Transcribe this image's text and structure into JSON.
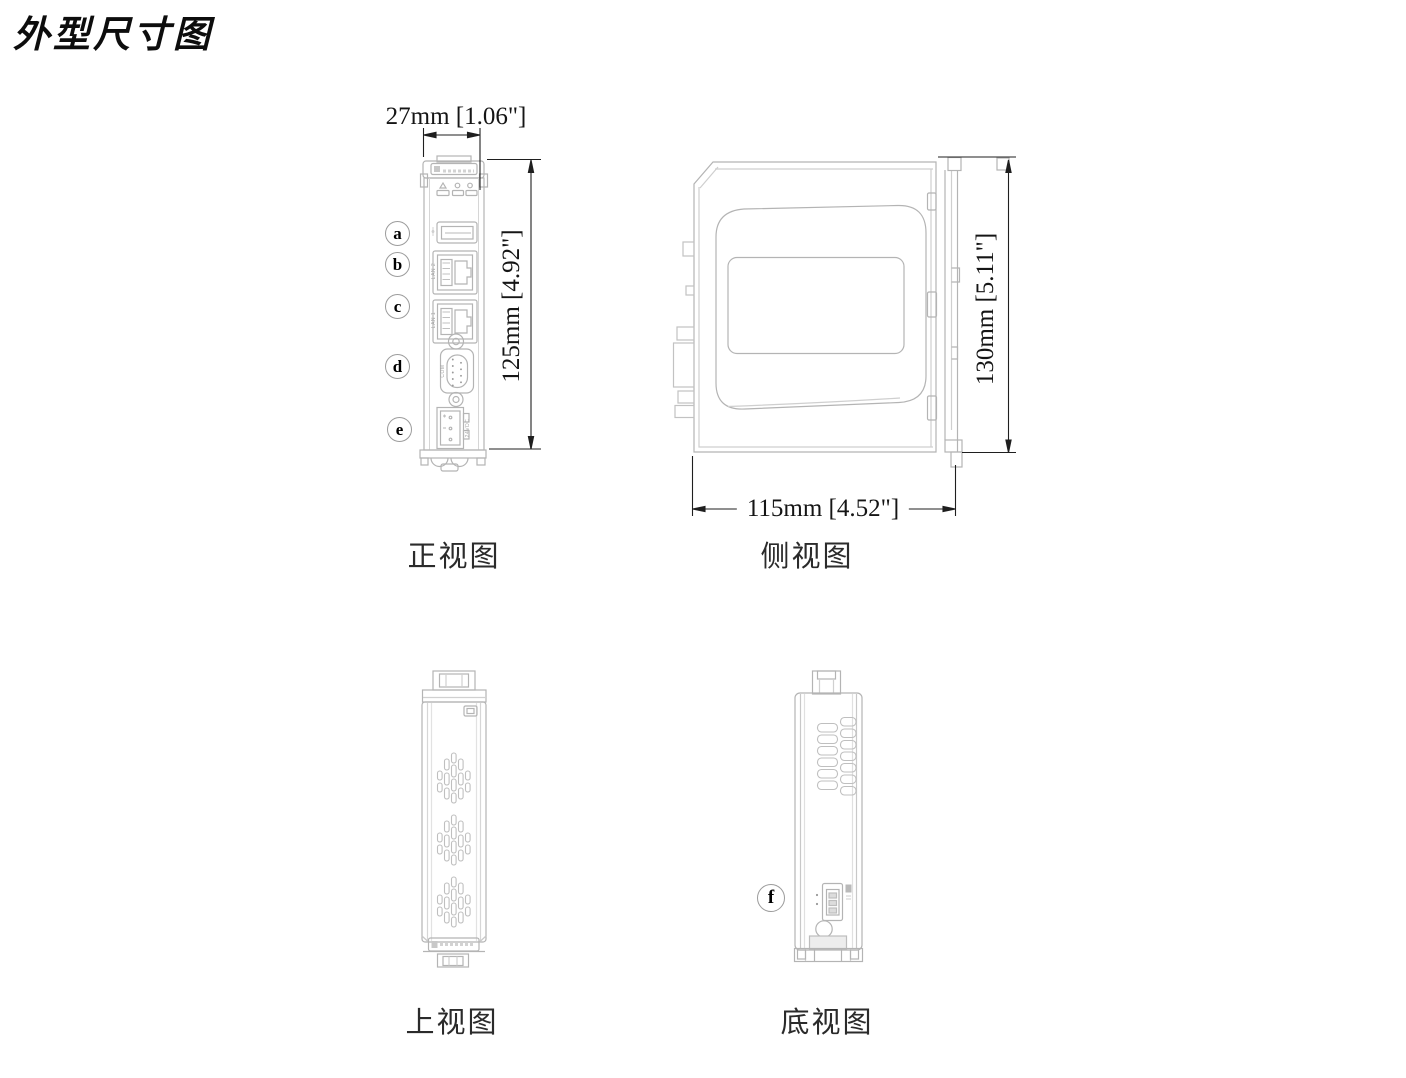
{
  "title": "外型尺寸图",
  "front": {
    "caption": "正视图",
    "dim_width": "27mm [1.06\"]",
    "dim_height": "125mm [4.92\"]",
    "labels": {
      "a": "a",
      "b": "b",
      "c": "c",
      "d": "d",
      "e": "e"
    },
    "ports": {
      "lan2": "LAN 2",
      "lan1": "LAN 1",
      "com": "COM",
      "power": "24VDC"
    }
  },
  "side": {
    "caption": "侧视图",
    "dim_width": "115mm [4.52\"]",
    "dim_height": "130mm [5.11\"]"
  },
  "top": {
    "caption": "上视图"
  },
  "bottom": {
    "caption": "底视图",
    "labels": {
      "f": "f"
    }
  }
}
